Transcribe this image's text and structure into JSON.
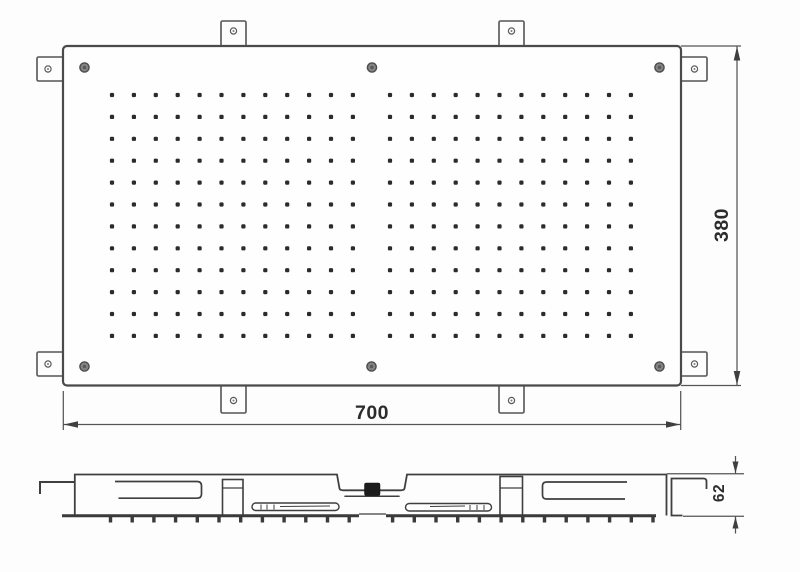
{
  "dimensions": {
    "width": "700",
    "height": "380",
    "depth": "62"
  },
  "top_view": {
    "nozzle_grid": {
      "rows": 12,
      "columns_per_block": 12,
      "blocks": [
        {
          "start_x": 112
        },
        {
          "start_x": 390
        }
      ],
      "start_y": 95,
      "spacing_x": 21.9,
      "spacing_y": 21.9,
      "dot_size": 4.2
    },
    "mounting_tab_count": 8,
    "screw_count": 6
  },
  "side_view": {
    "nozzle_ticks": {
      "count": 26,
      "start_x": 110.5,
      "spacing": 21.7,
      "skip_indices": [
        12
      ],
      "y": 517,
      "width": 3.4,
      "height": 5.5
    }
  },
  "colors": {
    "line": "#4a4a4a",
    "dark_line": "#3a3a3a",
    "dot": "#2b2b2b",
    "background": "#fdfdfd",
    "inlet_block": "#1c1c1c"
  }
}
